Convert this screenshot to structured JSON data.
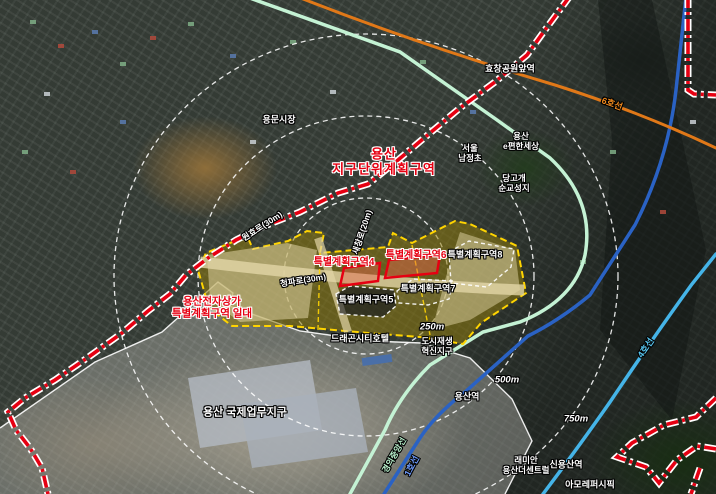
{
  "colors": {
    "boundary_red": "#e60012",
    "zone_yellow": "#ffd400",
    "line1_blue": "#2a62c4",
    "line4_lightblue": "#45b4e8",
    "line6_orange": "#e07818",
    "gyeongui_mint": "#c4f2d4",
    "ring_white": "#ffffff"
  },
  "region_labels": {
    "district_plan": {
      "line1": "용산",
      "line2": "지구단위계획구역"
    },
    "electronics": {
      "line1": "용산전자상가",
      "line2": "특별계획구역 일대"
    }
  },
  "zones": {
    "zone4": "특별계획구역4",
    "zone5": "특별계획구역5",
    "zone6": "특별계획구역6",
    "zone7": "특별계획구역7",
    "zone8": "특별계획구역8"
  },
  "places": {
    "yongmun_market": "용문시장",
    "hyochang_station": "효창공원앞역",
    "epyeonhan": {
      "line1": "용산",
      "line2": "e편한세상"
    },
    "namjeong": {
      "line1": "서울",
      "line2": "남정초"
    },
    "danggogae": {
      "line1": "당고개",
      "line2": "순교성지"
    },
    "dragon_city": "드래곤시티호텔",
    "urban_regen": {
      "line1": "도시재생",
      "line2": "혁신지구"
    },
    "ibd": "용산 국제업무지구",
    "yongsan_station": "용산역",
    "raemian": {
      "line1": "래미안",
      "line2": "용산더센트럴"
    },
    "sinyongsan_station": "신용산역",
    "amorepacific": "아모레퍼시픽"
  },
  "roads": {
    "wonhyo": "원효로(30m)",
    "saechang": "새창로(20m)",
    "cheongpa": "청파로(30m)"
  },
  "transit": {
    "line6": "6호선",
    "line1": "1호선",
    "line4": "4호선",
    "gyeongui": "경의중앙선"
  },
  "rings": {
    "r250": "250m",
    "r500": "500m",
    "r750": "750m"
  }
}
